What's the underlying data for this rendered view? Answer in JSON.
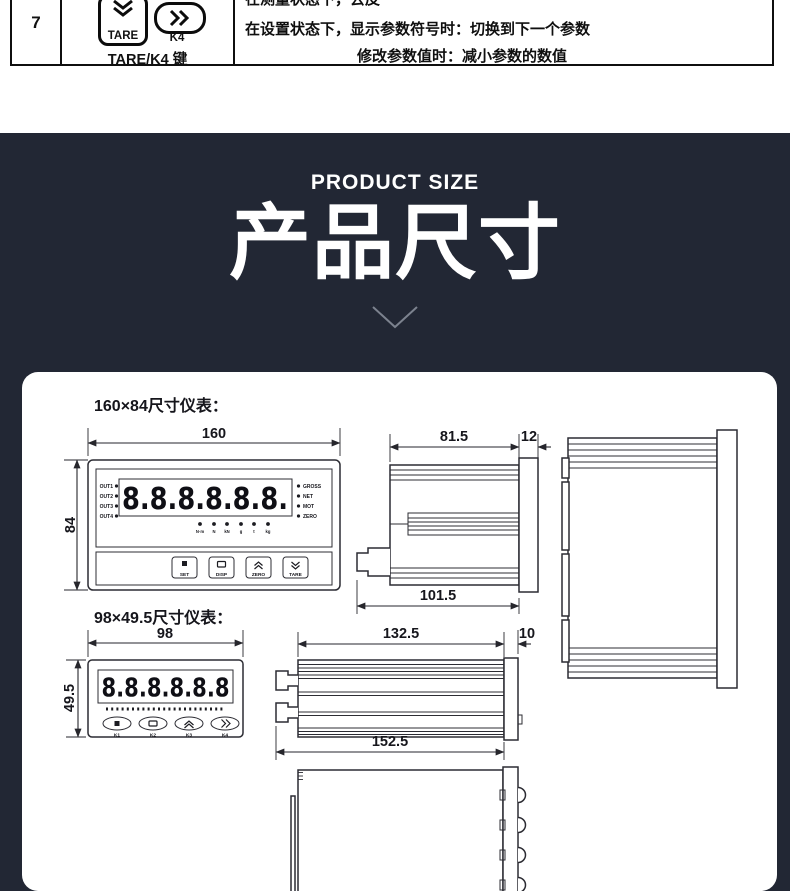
{
  "spec_table": {
    "row_number": "7",
    "key1_label": "TARE",
    "key2_label": "K4",
    "key_caption": "TARE/K4 键",
    "desc_lines": [
      "在测量状态下，去皮",
      "在设置状态下，显示参数符号时：切换到下一个参数",
      "修改参数值时：减小参数的数值"
    ]
  },
  "hero": {
    "subtitle": "PRODUCT SIZE",
    "title": "产品尺寸",
    "background_color": "#222734"
  },
  "drawings": {
    "meter1": {
      "caption": "160×84尺寸仪表：",
      "dims": {
        "width": "160",
        "height": "84",
        "depth": "81.5",
        "bezel": "12",
        "total_depth": "101.5"
      },
      "display_value": "8.8.8.8.8.8.",
      "out_labels": [
        "OUT1",
        "OUT2",
        "OUT3",
        "OUT4"
      ],
      "status_labels": [
        "GROSS",
        "NET",
        "MOT",
        "ZERO"
      ],
      "unit_labels": [
        "N·m",
        "N",
        "kN",
        "g",
        "t",
        "kg"
      ],
      "button_labels": [
        "SET",
        "DISP",
        "ZERO",
        "TARE"
      ]
    },
    "meter2": {
      "caption": "98×49.5尺寸仪表：",
      "dims": {
        "width": "98",
        "height": "49.5",
        "depth": "132.5",
        "bezel": "10",
        "total_depth": "152.5"
      },
      "display_value": "8.8.8.8.8.8",
      "button_labels": [
        "K1",
        "K2",
        "K3",
        "K4"
      ]
    }
  }
}
